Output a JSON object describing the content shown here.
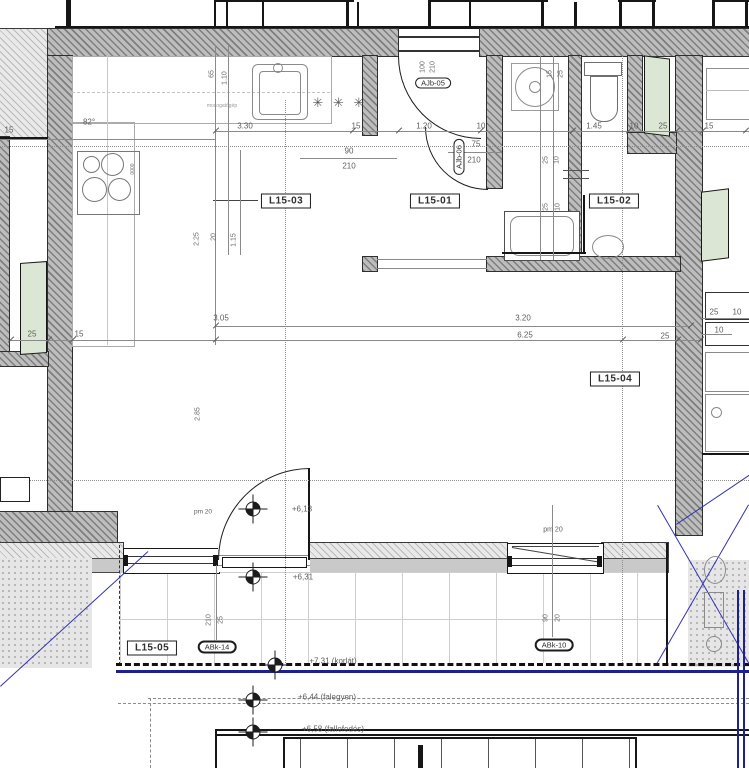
{
  "rooms": {
    "l1503": "L15-03",
    "l1501": "L15-01",
    "l1502": "L15-02",
    "l1504": "L15-04",
    "l1505": "L15-05"
  },
  "openings": {
    "ajb05": "AJb-05",
    "ajb06": "AJb-06",
    "abk14": "ABk-14",
    "abk10": "ABk-10"
  },
  "dims": {
    "tc": [
      "3.30",
      "15",
      "1.20",
      "10",
      "1.45",
      "10",
      "25",
      "15"
    ],
    "left": [
      "82°",
      "15"
    ],
    "entry": [
      "100",
      "210"
    ],
    "halldoor": [
      "75",
      "210"
    ],
    "kdoor": [
      "90",
      "210"
    ],
    "kv": [
      "65",
      "1.10",
      "2.25",
      "20",
      "1.15",
      "2.85"
    ],
    "appliance": "mosogatógép",
    "mid": [
      "3.05",
      "3.20",
      "25",
      "15",
      "6.25",
      "25"
    ],
    "bath": [
      "15",
      "25",
      "25",
      "10",
      "25",
      "10"
    ],
    "right": [
      "25",
      "10",
      "10"
    ],
    "pm1": "pm 20",
    "pm2": "pm 20",
    "abk14d": [
      "210",
      "25"
    ],
    "abk10d": [
      "90",
      "20"
    ],
    "knobs": "0000",
    "stars": "✳ ✳ ✳"
  },
  "elev": {
    "a": "+6,13",
    "b": "+6,31",
    "c": "+7,31 (korlát)",
    "d": "+6,44 (falegyen)",
    "e": "+6,58 (fallefedés)"
  }
}
